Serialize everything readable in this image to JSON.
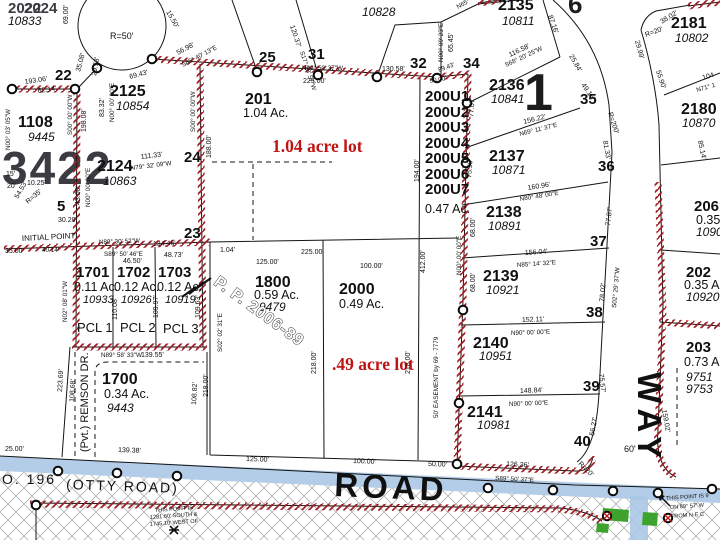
{
  "watermarks": {
    "y1": "2022",
    "y2": "2024",
    "acct": "10833",
    "big": "3422",
    "block": "1",
    "six": "6"
  },
  "red_notes": {
    "a": "1.04 acre lot",
    "b": ".49 acre lot"
  },
  "roads": {
    "road": "ROAD",
    "way": "WAY",
    "otty": "(OTTY ROAD)",
    "no196": "O. 196",
    "remson": "(Pvt.) REMSON DR.",
    "width60": "60'"
  },
  "lots": {
    "l1108": {
      "id": "1108",
      "acct": "9445"
    },
    "l2125": {
      "id": "2125",
      "acct": "10854"
    },
    "l2124": {
      "id": "2124",
      "acct": "10863"
    },
    "l201": {
      "id": "201",
      "ac": "1.04 Ac."
    },
    "l10828": {
      "acct": "10828"
    },
    "l2135": {
      "id": "2135",
      "acct": "10811"
    },
    "l2136": {
      "id": "2136",
      "acct": "10841"
    },
    "l2137": {
      "id": "2137",
      "acct": "10871"
    },
    "l2138": {
      "id": "2138",
      "acct": "10891"
    },
    "l2139": {
      "id": "2139",
      "acct": "10921"
    },
    "l2140": {
      "id": "2140",
      "acct": "10951"
    },
    "l2141": {
      "id": "2141",
      "acct": "10981"
    },
    "l2181": {
      "id": "2181",
      "acct": "10802"
    },
    "l2180": {
      "id": "2180",
      "acct": "10870"
    },
    "l206": {
      "id": "206",
      "ac": "0.35",
      "acct": "1090"
    },
    "l202": {
      "id": "202",
      "ac": "0.35 A",
      "acct": "10920"
    },
    "l203": {
      "id": "203",
      "ac": "0.73 A",
      "acct1": "9751",
      "acct2": "9753"
    },
    "units": {
      "u1": "200U1",
      "u2": "200U2",
      "u3": "200U3",
      "u4": "200U4",
      "u5": "200U5",
      "u6": "200U6",
      "u7": "200U7",
      "ac": "0.47 Ac."
    },
    "l1701": {
      "id": "1701",
      "ac": "0.11 Ac.",
      "acct": "10933",
      "pcl": "PCL 1"
    },
    "l1702": {
      "id": "1702",
      "ac": "0.12 Ac.",
      "acct": "10926",
      "pcl": "PCL 2"
    },
    "l1703": {
      "id": "1703",
      "ac": "0.12 Ac.",
      "acct": "10919",
      "pcl": "PCL 3"
    },
    "l1700": {
      "id": "1700",
      "ac": "0.34 Ac.",
      "acct": "9443"
    },
    "l1800": {
      "id": "1800",
      "ac": "0.59 Ac.",
      "acct": "9479"
    },
    "l2000": {
      "id": "2000",
      "ac": "0.49 Ac."
    },
    "pp": "P. P. 2006-89"
  },
  "points": {
    "p5": "5",
    "p22": "22",
    "p23": "23",
    "p24": "24",
    "p25": "25",
    "p31": "31",
    "p32": "32",
    "p34": "34",
    "p35": "35",
    "p36": "36",
    "p37": "37",
    "p38": "38",
    "p39": "39",
    "p40": "40"
  },
  "dims": {
    "r50": "R=50'",
    "d1550": "15.50'",
    "d6900": "69.00'",
    "d2958": "29.58'",
    "d3508": "35.08'",
    "d5698": "56.98'",
    "s6540": "S65° 40' 13\"E",
    "d6943": "69.43'",
    "d19306": "193.06'",
    "d6214": "62.14'",
    "n0003": "N00° 03' 05\"W",
    "s0000a": "S00° 00' 00\"W",
    "d19808": "198.08'",
    "d4300": "43.00'",
    "n0000a": "N00° 00' 00\"E",
    "d8332": "83.32'",
    "n0000b": "N00° 00' 00\"E",
    "s0000b": "S00° 00' 00\"W",
    "d18800": "188.00'",
    "d1025": "10.25'",
    "d20": "20'",
    "d15": "15'",
    "r35": "R=35'",
    "d5453": "54.53'",
    "d3020": "30.20'",
    "init": "INITIAL POINT",
    "d3500": "35.00'",
    "d11133": "111.33'",
    "n7932": "N79° 32' 09\"W",
    "n8930": "N89° 30' 52\"W",
    "d13446": "134.46'",
    "d4014": "40.14'",
    "s8950b": "S89° 50' 46\"E",
    "d4650": "46.50'",
    "d4873": "48.73'",
    "d104": "1.04'",
    "n8950": "N89° 50' 37\"W",
    "d13058": "130.58'",
    "d22500a": "225.00'",
    "s1728": "S17° 28' 57\"W",
    "d12037": "120.37'",
    "n0009": "N00° 09' 23\"E",
    "d6545": "65.45'",
    "n65": "N65°",
    "d8716": "87.16'",
    "d11658": "116.58'",
    "s6820": "S68° 20' 25\"W",
    "d2584": "25.84'",
    "d4916": "49.16'",
    "r200": "R=200'",
    "d8133": "81.33'",
    "d15622": "156.22'",
    "n6911": "N69° 11' 37\"E",
    "d2999": "29.99'",
    "r20a": "R=20'",
    "d3802": "38.02'",
    "d5590": "55.90'",
    "d104b": "104",
    "n71": "N71° 1",
    "d8514": "85.14'",
    "d16096": "160.96'",
    "n8048": "N80° 48' 00\"E",
    "d7787": "77.87'",
    "d15604": "156.04'",
    "n8514": "N85° 14' 32\"E",
    "d7802": "78.02'",
    "s0229": "S02° 29' 37\"W",
    "d15211": "152.11'",
    "n9000a": "N90° 00' 00\"E",
    "d14884": "148.84'",
    "n9000b": "N90° 00' 00\"E",
    "d5627": "56.27'",
    "d12636": "126.36'",
    "s8950": "S89° 50' 37\"E",
    "r20b": "R=20'",
    "d7557": "75.57'",
    "d15902": "159.02'",
    "d8943": "89.43'",
    "d5000a": "50.00'",
    "d7707": "77.07'",
    "d7599": "75.99'",
    "d19400": "194.00'",
    "d41200": "412.00'",
    "n0000c": "N00° 00' 00\"E",
    "d6800a": "68.00'",
    "d6800b": "68.00'",
    "ease": "50' EASEMENT by 69 - 7779",
    "d21800a": "218.00'",
    "d21800b": "218.00'",
    "d12500a": "125.00'",
    "d22500b": "225.00'",
    "d10000a": "100.00'",
    "d12500b": "125.00'",
    "d10000b": "100.00'",
    "d5000b": "50.00'",
    "d13938": "139.38'",
    "d2500": "25.00'",
    "n8958": "N89° 58' 33\"W",
    "d13955": "139.55'",
    "n0208": "N02° 08' 01\"W",
    "d11008": "110.08'",
    "d10997": "109.97'",
    "d10963": "109.63'",
    "s0202": "S02° 02' 31\"E",
    "d22369": "223.69'",
    "d10868": "108.68'",
    "d21800c": "218.00'",
    "d10882": "108.82'",
    "d60": "60'"
  },
  "notes": {
    "a1": "THIS POINT IS",
    "a2": "1281.60' SOUTH &",
    "a3": "1745.10' WEST OF",
    "b1": "THIS POINT IS 9",
    "b2": "ON 89° 57' W",
    "b3": "FROM N-E C"
  },
  "colors": {
    "boundary_red": "#a01d24",
    "road_blue": "#a9c6e5",
    "highlight_green": "#3da32c",
    "note_red": "#c01414"
  }
}
